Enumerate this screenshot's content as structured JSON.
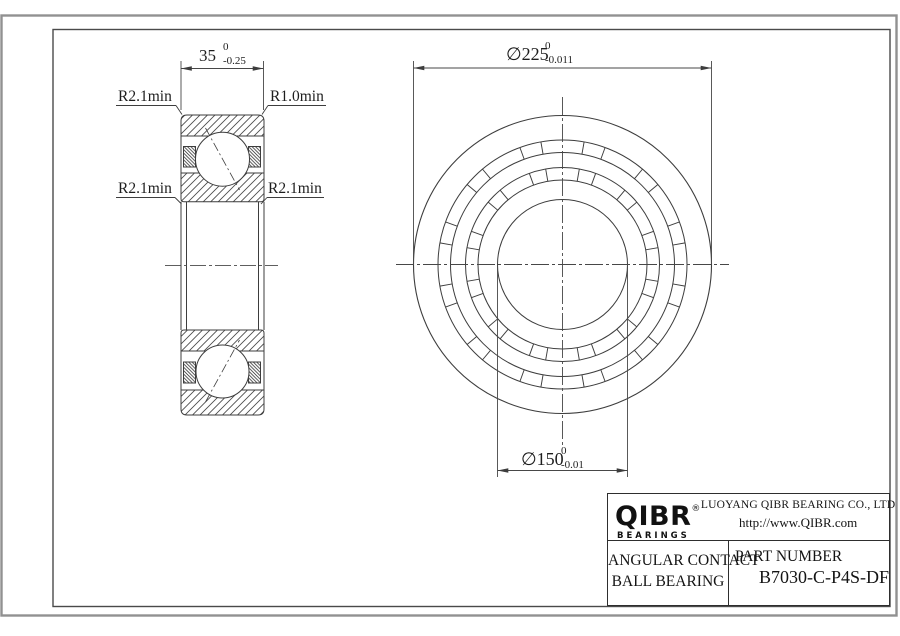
{
  "drawing": {
    "section_view": {
      "width_dim": {
        "value": "35",
        "tol_upper": "0",
        "tol_lower": "-0.25"
      },
      "labels": {
        "top_left": "R2.1min",
        "top_right": "R1.0min",
        "mid_left": "R2.1min",
        "mid_right": "R2.1min"
      }
    },
    "front_view": {
      "outer_dim": {
        "value": "∅225",
        "tol_upper": "0",
        "tol_lower": "-0.011"
      },
      "bore_dim": {
        "value": "∅150",
        "tol_upper": "0",
        "tol_lower": "-0.01"
      }
    }
  },
  "title_block": {
    "logo": {
      "text": "QIBR",
      "registered": "®",
      "sub": "BEARINGS"
    },
    "company": "LUOYANG QIBR BEARING CO., LTD",
    "website": "http://www.QIBR.com",
    "product": {
      "line1": "ANGULAR CONTACT",
      "line2": "BALL BEARING"
    },
    "part_number_label": "PART NUMBER",
    "part_number": "B7030-C-P4S-DF"
  },
  "colors": {
    "part_line": "#3d3d3d",
    "dim_line": "#474747",
    "frame_inner": "#4a4a4a",
    "frame_outer": "#919191",
    "text": "#1e1e1e"
  }
}
